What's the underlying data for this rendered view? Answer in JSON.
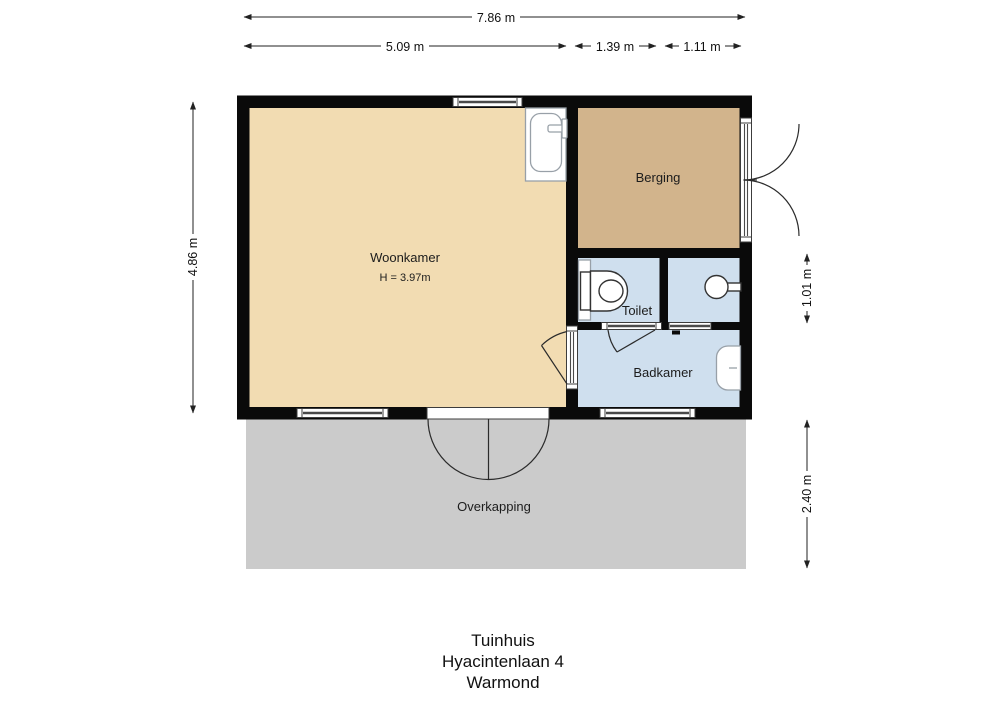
{
  "dimensions": {
    "total_width": "7.86 m",
    "left_section_width": "5.09 m",
    "middle_section_width": "1.39 m",
    "right_section_width": "1.11 m",
    "building_height": "4.86 m",
    "toilet_row_height": "1.01 m",
    "overkapping_depth": "2.40 m"
  },
  "rooms": {
    "woonkamer": {
      "label": "Woonkamer",
      "ceiling_height": "H = 3.97m"
    },
    "berging": {
      "label": "Berging"
    },
    "toilet": {
      "label": "Toilet"
    },
    "badkamer": {
      "label": "Badkamer"
    },
    "overkapping": {
      "label": "Overkapping"
    }
  },
  "title": {
    "line1": "Tuinhuis",
    "line2": "Hyacintenlaan 4",
    "line3": "Warmond"
  },
  "colors": {
    "woonkamer": "#f2dcb2",
    "berging": "#d2b48c",
    "bathroom": "#cfdfee",
    "overkapping": "#cbcbcb",
    "wall": "#0a0a0a",
    "line": "#222222"
  }
}
